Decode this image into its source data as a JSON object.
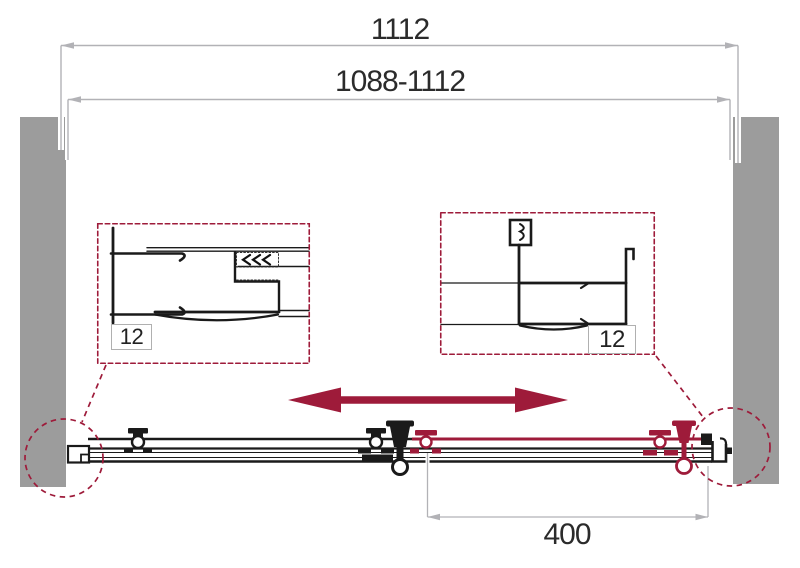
{
  "drawing_type": "shower-door-width-adjustment-diagram",
  "dimensions": {
    "total_width": "1112",
    "adjustable_range": "1088-1112",
    "door_panel_width": "400"
  },
  "details": {
    "left_profile": {
      "label": "12"
    },
    "right_profile": {
      "label": "12"
    }
  },
  "colors": {
    "accent_crimson": "#9e1b3a",
    "wall_gray": "#9c9c9c",
    "dimension_gray": "#b2b2b6",
    "line_black": "#1a1a1a",
    "text": "#2b2b2b"
  }
}
